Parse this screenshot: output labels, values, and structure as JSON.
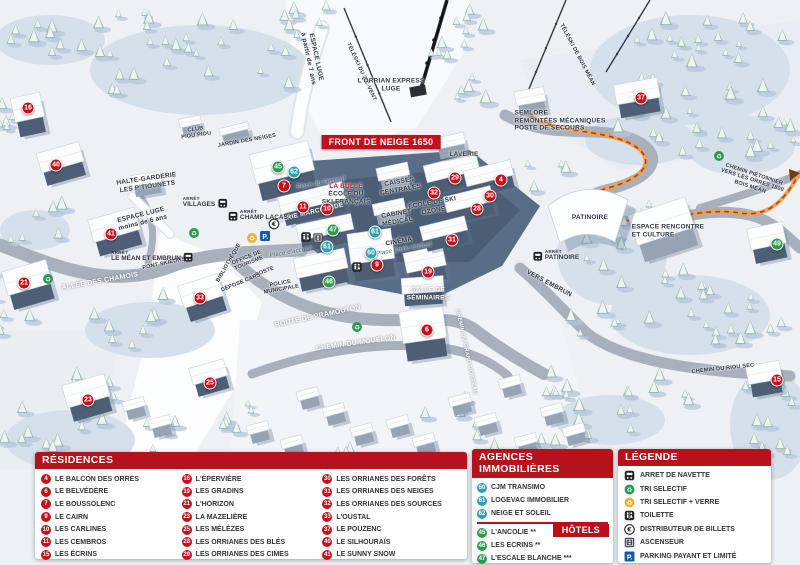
{
  "colors": {
    "header_red": "#b5121b",
    "marker_red": "#c4111c",
    "agency_teal": "#2ba3b4",
    "hotel_green": "#2c9b4e",
    "parking_blue": "#1558a7",
    "path_orange": "#eba24d"
  },
  "map": {
    "banner": {
      "text": "FRONT DE NEIGE 1650",
      "x": 381,
      "y": 142
    },
    "markers": [
      {
        "n": 4,
        "x": 501,
        "y": 180,
        "g": "res"
      },
      {
        "n": 6,
        "x": 427,
        "y": 330,
        "g": "res"
      },
      {
        "n": 7,
        "x": 284,
        "y": 186,
        "g": "res"
      },
      {
        "n": 9,
        "x": 377,
        "y": 265,
        "g": "res"
      },
      {
        "n": 10,
        "x": 327,
        "y": 209,
        "g": "res"
      },
      {
        "n": 11,
        "x": 303,
        "y": 207,
        "g": "res"
      },
      {
        "n": 15,
        "x": 777,
        "y": 380,
        "g": "res"
      },
      {
        "n": 16,
        "x": 28,
        "y": 108,
        "g": "res"
      },
      {
        "n": 19,
        "x": 428,
        "y": 272,
        "g": "res"
      },
      {
        "n": 21,
        "x": 24,
        "y": 283,
        "g": "res"
      },
      {
        "n": 23,
        "x": 88,
        "y": 400,
        "g": "res"
      },
      {
        "n": 25,
        "x": 210,
        "y": 383,
        "g": "res"
      },
      {
        "n": 28,
        "x": 477,
        "y": 209,
        "g": "res"
      },
      {
        "n": 29,
        "x": 455,
        "y": 178,
        "g": "res"
      },
      {
        "n": 30,
        "x": 490,
        "y": 196,
        "g": "res"
      },
      {
        "n": 31,
        "x": 452,
        "y": 240,
        "g": "res"
      },
      {
        "n": 32,
        "x": 434,
        "y": 193,
        "g": "res"
      },
      {
        "n": 33,
        "x": 200,
        "y": 298,
        "g": "res"
      },
      {
        "n": 37,
        "x": 641,
        "y": 98,
        "g": "res"
      },
      {
        "n": 40,
        "x": 56,
        "y": 165,
        "g": "res"
      },
      {
        "n": 41,
        "x": 111,
        "y": 234,
        "g": "res"
      },
      {
        "n": 60,
        "x": 371,
        "y": 253,
        "g": "age"
      },
      {
        "n": 61,
        "x": 327,
        "y": 247,
        "g": "age"
      },
      {
        "n": 61,
        "x": 375,
        "y": 232,
        "g": "age"
      },
      {
        "n": 62,
        "x": 294,
        "y": 172,
        "g": "age"
      },
      {
        "n": 45,
        "x": 278,
        "y": 167,
        "g": "hot"
      },
      {
        "n": 46,
        "x": 329,
        "y": 282,
        "g": "hot"
      },
      {
        "n": 47,
        "x": 333,
        "y": 230,
        "g": "hot"
      },
      {
        "n": 49,
        "x": 777,
        "y": 244,
        "g": "hot"
      }
    ],
    "labels": [
      {
        "t": "ESPACE LUGE|à partir de 7 ans",
        "x": 312,
        "y": 58,
        "r": 78,
        "c": "tiny"
      },
      {
        "t": "TÉLÉSKI DU ZIC-VENT",
        "x": 361,
        "y": 72,
        "r": 65,
        "c": "micro"
      },
      {
        "t": "L'ORRIAN EXPRESS|LUGE",
        "x": 391,
        "y": 85,
        "r": 0,
        "c": "tiny"
      },
      {
        "t": "SEMLORE|REMONTÉES MÉCANIQUES|POSTE DE SECOURS",
        "x": 560,
        "y": 121,
        "r": 0,
        "c": "tiny left"
      },
      {
        "t": "LAVERIE",
        "x": 464,
        "y": 155,
        "r": 0,
        "c": "tiny"
      },
      {
        "t": "CAISSES|CENTRALES",
        "x": 400,
        "y": 186,
        "r": -10,
        "c": "tiny"
      },
      {
        "t": "LA BULLE",
        "x": 346,
        "y": 187,
        "r": 0,
        "c": "tiny red"
      },
      {
        "t": "ÉCOLE DU|SKI FRANÇAIS",
        "x": 346,
        "y": 198,
        "r": 0,
        "c": "tiny"
      },
      {
        "t": "ÉCOLE DE SKI|OZONE",
        "x": 433,
        "y": 207,
        "r": -10,
        "c": "tiny"
      },
      {
        "t": "CABINET|MÉDICAL",
        "x": 397,
        "y": 218,
        "r": -10,
        "c": "tiny"
      },
      {
        "t": "CINÉMA",
        "x": 399,
        "y": 242,
        "r": -10,
        "c": "tiny"
      },
      {
        "t": "Place Émile Hodoul",
        "x": 404,
        "y": 250,
        "r": -10,
        "c": "place"
      },
      {
        "t": "Place du Festival",
        "x": 321,
        "y": 184,
        "r": -10,
        "c": "place"
      },
      {
        "t": "Place d'accueil",
        "x": 291,
        "y": 253,
        "r": -10,
        "c": "place"
      },
      {
        "t": "GALERIE MARCHANDE",
        "x": 306,
        "y": 214,
        "r": -13,
        "c": "tiny white"
      },
      {
        "t": "HALTE-GARDERIE|LES P'TIOUNETS",
        "x": 147,
        "y": 183,
        "r": -8,
        "c": "tiny"
      },
      {
        "t": "ESPACE LUGE|moins de 6 ans",
        "x": 142,
        "y": 219,
        "r": -14,
        "c": "tiny"
      },
      {
        "t": "CLUB|PIOU PIOU",
        "x": 196,
        "y": 133,
        "r": -8,
        "c": "micro"
      },
      {
        "t": "JARDIN DES NEIGES",
        "x": 247,
        "y": 141,
        "r": -10,
        "c": "micro"
      },
      {
        "t": "ALLÉE DES CHAMOIS",
        "x": 100,
        "y": 282,
        "r": -10,
        "c": "road"
      },
      {
        "t": "PONT SKIEURS",
        "x": 164,
        "y": 264,
        "r": -12,
        "c": "micro"
      },
      {
        "t": "BIBLIOTHÈQUE",
        "x": 229,
        "y": 263,
        "r": -60,
        "c": "micro"
      },
      {
        "t": "OFFICE DE|TOURISME",
        "x": 248,
        "y": 261,
        "r": -22,
        "c": "micro"
      },
      {
        "t": "POSTE",
        "x": 265,
        "y": 272,
        "r": -22,
        "c": "micro"
      },
      {
        "t": "DÉPOSE CARS",
        "x": 241,
        "y": 283,
        "r": -22,
        "c": "micro"
      },
      {
        "t": "POLICE|MUNICIPALE",
        "x": 281,
        "y": 287,
        "r": -10,
        "c": "micro"
      },
      {
        "t": "ROUTE DE PRAMOUTON",
        "x": 318,
        "y": 317,
        "r": -12,
        "c": "road"
      },
      {
        "t": "CHEMIN DU MOUFLON",
        "x": 356,
        "y": 344,
        "r": -8,
        "c": "road"
      },
      {
        "t": "SALLE DE|SÉMINAIRES",
        "x": 428,
        "y": 294,
        "r": 0,
        "c": "tiny white"
      },
      {
        "t": "CHEMIN DU GRAND CORREAU",
        "x": 466,
        "y": 352,
        "r": 78,
        "c": "road",
        "fs": 5.5
      },
      {
        "t": "VERS EMBRUN",
        "x": 549,
        "y": 284,
        "r": 28,
        "c": "tiny"
      },
      {
        "t": "PATINOIRE",
        "x": 590,
        "y": 218,
        "r": 0,
        "c": "tiny"
      },
      {
        "t": "ESPACE RENCONTRE|ET CULTURE",
        "x": 668,
        "y": 231,
        "r": 0,
        "c": "tiny left"
      },
      {
        "t": "CHEMIN PIÉTONNIER|VERS LES ORRES 1800|BOIS MÉAN",
        "x": 752,
        "y": 181,
        "r": 18,
        "c": "micro"
      },
      {
        "t": "TÉLÉSKI DE BOIS MÉAN",
        "x": 577,
        "y": 55,
        "r": 62,
        "c": "micro"
      },
      {
        "t": "CHEMIN DU RIOU SEC",
        "x": 723,
        "y": 369,
        "r": -6,
        "c": "micro"
      }
    ],
    "stops": [
      {
        "t": "VILLAGES",
        "x": 205,
        "y": 203,
        "icon": "right"
      },
      {
        "t": "CHAMP LACAS",
        "x": 258,
        "y": 216,
        "icon": "left"
      },
      {
        "t": "LE MÉAN ET EMBRUN",
        "x": 152,
        "y": 257,
        "icon": "right"
      },
      {
        "t": "PATINOIRE",
        "x": 556,
        "y": 256,
        "icon": "left"
      }
    ],
    "icons": [
      {
        "type": "euro",
        "x": 274,
        "y": 224
      },
      {
        "type": "parking",
        "x": 265,
        "y": 236
      },
      {
        "type": "recycle-glass",
        "x": 252,
        "y": 238
      },
      {
        "type": "toilet",
        "x": 306,
        "y": 237
      },
      {
        "type": "elevator",
        "x": 318,
        "y": 238
      },
      {
        "type": "toilet",
        "x": 357,
        "y": 267
      },
      {
        "type": "recycle",
        "x": 48,
        "y": 279
      },
      {
        "type": "recycle",
        "x": 194,
        "y": 233
      },
      {
        "type": "recycle",
        "x": 357,
        "y": 327
      },
      {
        "type": "recycle",
        "x": 719,
        "y": 156
      }
    ]
  },
  "panels": {
    "residences": {
      "title": "RÉSIDENCES",
      "items": [
        {
          "n": 4,
          "name": "LE BALCON DES ORRES"
        },
        {
          "n": 6,
          "name": "LE BELVÉDÈRE"
        },
        {
          "n": 7,
          "name": "LE BOUSSOLENC"
        },
        {
          "n": 9,
          "name": "LE CAIRN"
        },
        {
          "n": 10,
          "name": "LES CARLINES"
        },
        {
          "n": 11,
          "name": "LES CEMBROS"
        },
        {
          "n": 15,
          "name": "LES ÉCRINS"
        },
        {
          "n": 16,
          "name": "L'ÉPERVIÈRE"
        },
        {
          "n": 19,
          "name": "LES GRADINS"
        },
        {
          "n": 21,
          "name": "L'HORIZON"
        },
        {
          "n": 23,
          "name": "LA MAZELIÈRE"
        },
        {
          "n": 25,
          "name": "LES MÉLÈZES"
        },
        {
          "n": 28,
          "name": "LES ORRIANES DES BLÉS"
        },
        {
          "n": 29,
          "name": "LES ORRIANES DES CIMES"
        },
        {
          "n": 30,
          "name": "LES ORRIANES DES FORÊTS"
        },
        {
          "n": 31,
          "name": "LES ORRIANES DES NEIGES"
        },
        {
          "n": 32,
          "name": "LES ORRIANES DES SOURCES"
        },
        {
          "n": 33,
          "name": "L'OUSTAL"
        },
        {
          "n": 37,
          "name": "LE POUZENC"
        },
        {
          "n": 40,
          "name": "LE SILHOURAÏS"
        },
        {
          "n": 41,
          "name": "LE SUNNY SNOW"
        }
      ]
    },
    "agences": {
      "title": "AGENCES IMMOBILIÈRES",
      "items": [
        {
          "n": 60,
          "name": "CJM TRANSIMO"
        },
        {
          "n": 61,
          "name": "LOGEVAC IMMOBILIER"
        },
        {
          "n": 62,
          "name": "NEIGE ET SOLEIL"
        }
      ]
    },
    "hotels": {
      "title": "HÔTELS",
      "items": [
        {
          "n": 45,
          "name": "L'ANCOLIE **"
        },
        {
          "n": 46,
          "name": "LES ECRINS **"
        },
        {
          "n": 47,
          "name": "L'ESCALE BLANCHE ***"
        },
        {
          "n": 49,
          "name": "LES TRAPPEURS **"
        }
      ]
    },
    "legend": {
      "title": "LÉGENDE",
      "items": [
        {
          "icon": "bus",
          "label": "ARRET DE NAVETTE"
        },
        {
          "icon": "recycle",
          "label": "TRI SELECTIF"
        },
        {
          "icon": "recycle-glass",
          "label": "TRI SELECTIF + VERRE"
        },
        {
          "icon": "toilet",
          "label": "TOILETTE"
        },
        {
          "icon": "euro",
          "label": "DISTRIBUTEUR DE BILLETS"
        },
        {
          "icon": "elevator",
          "label": "ASCENSEUR"
        },
        {
          "icon": "parking",
          "label": "PARKING PAYANT ET LIMITÉ"
        }
      ]
    }
  }
}
